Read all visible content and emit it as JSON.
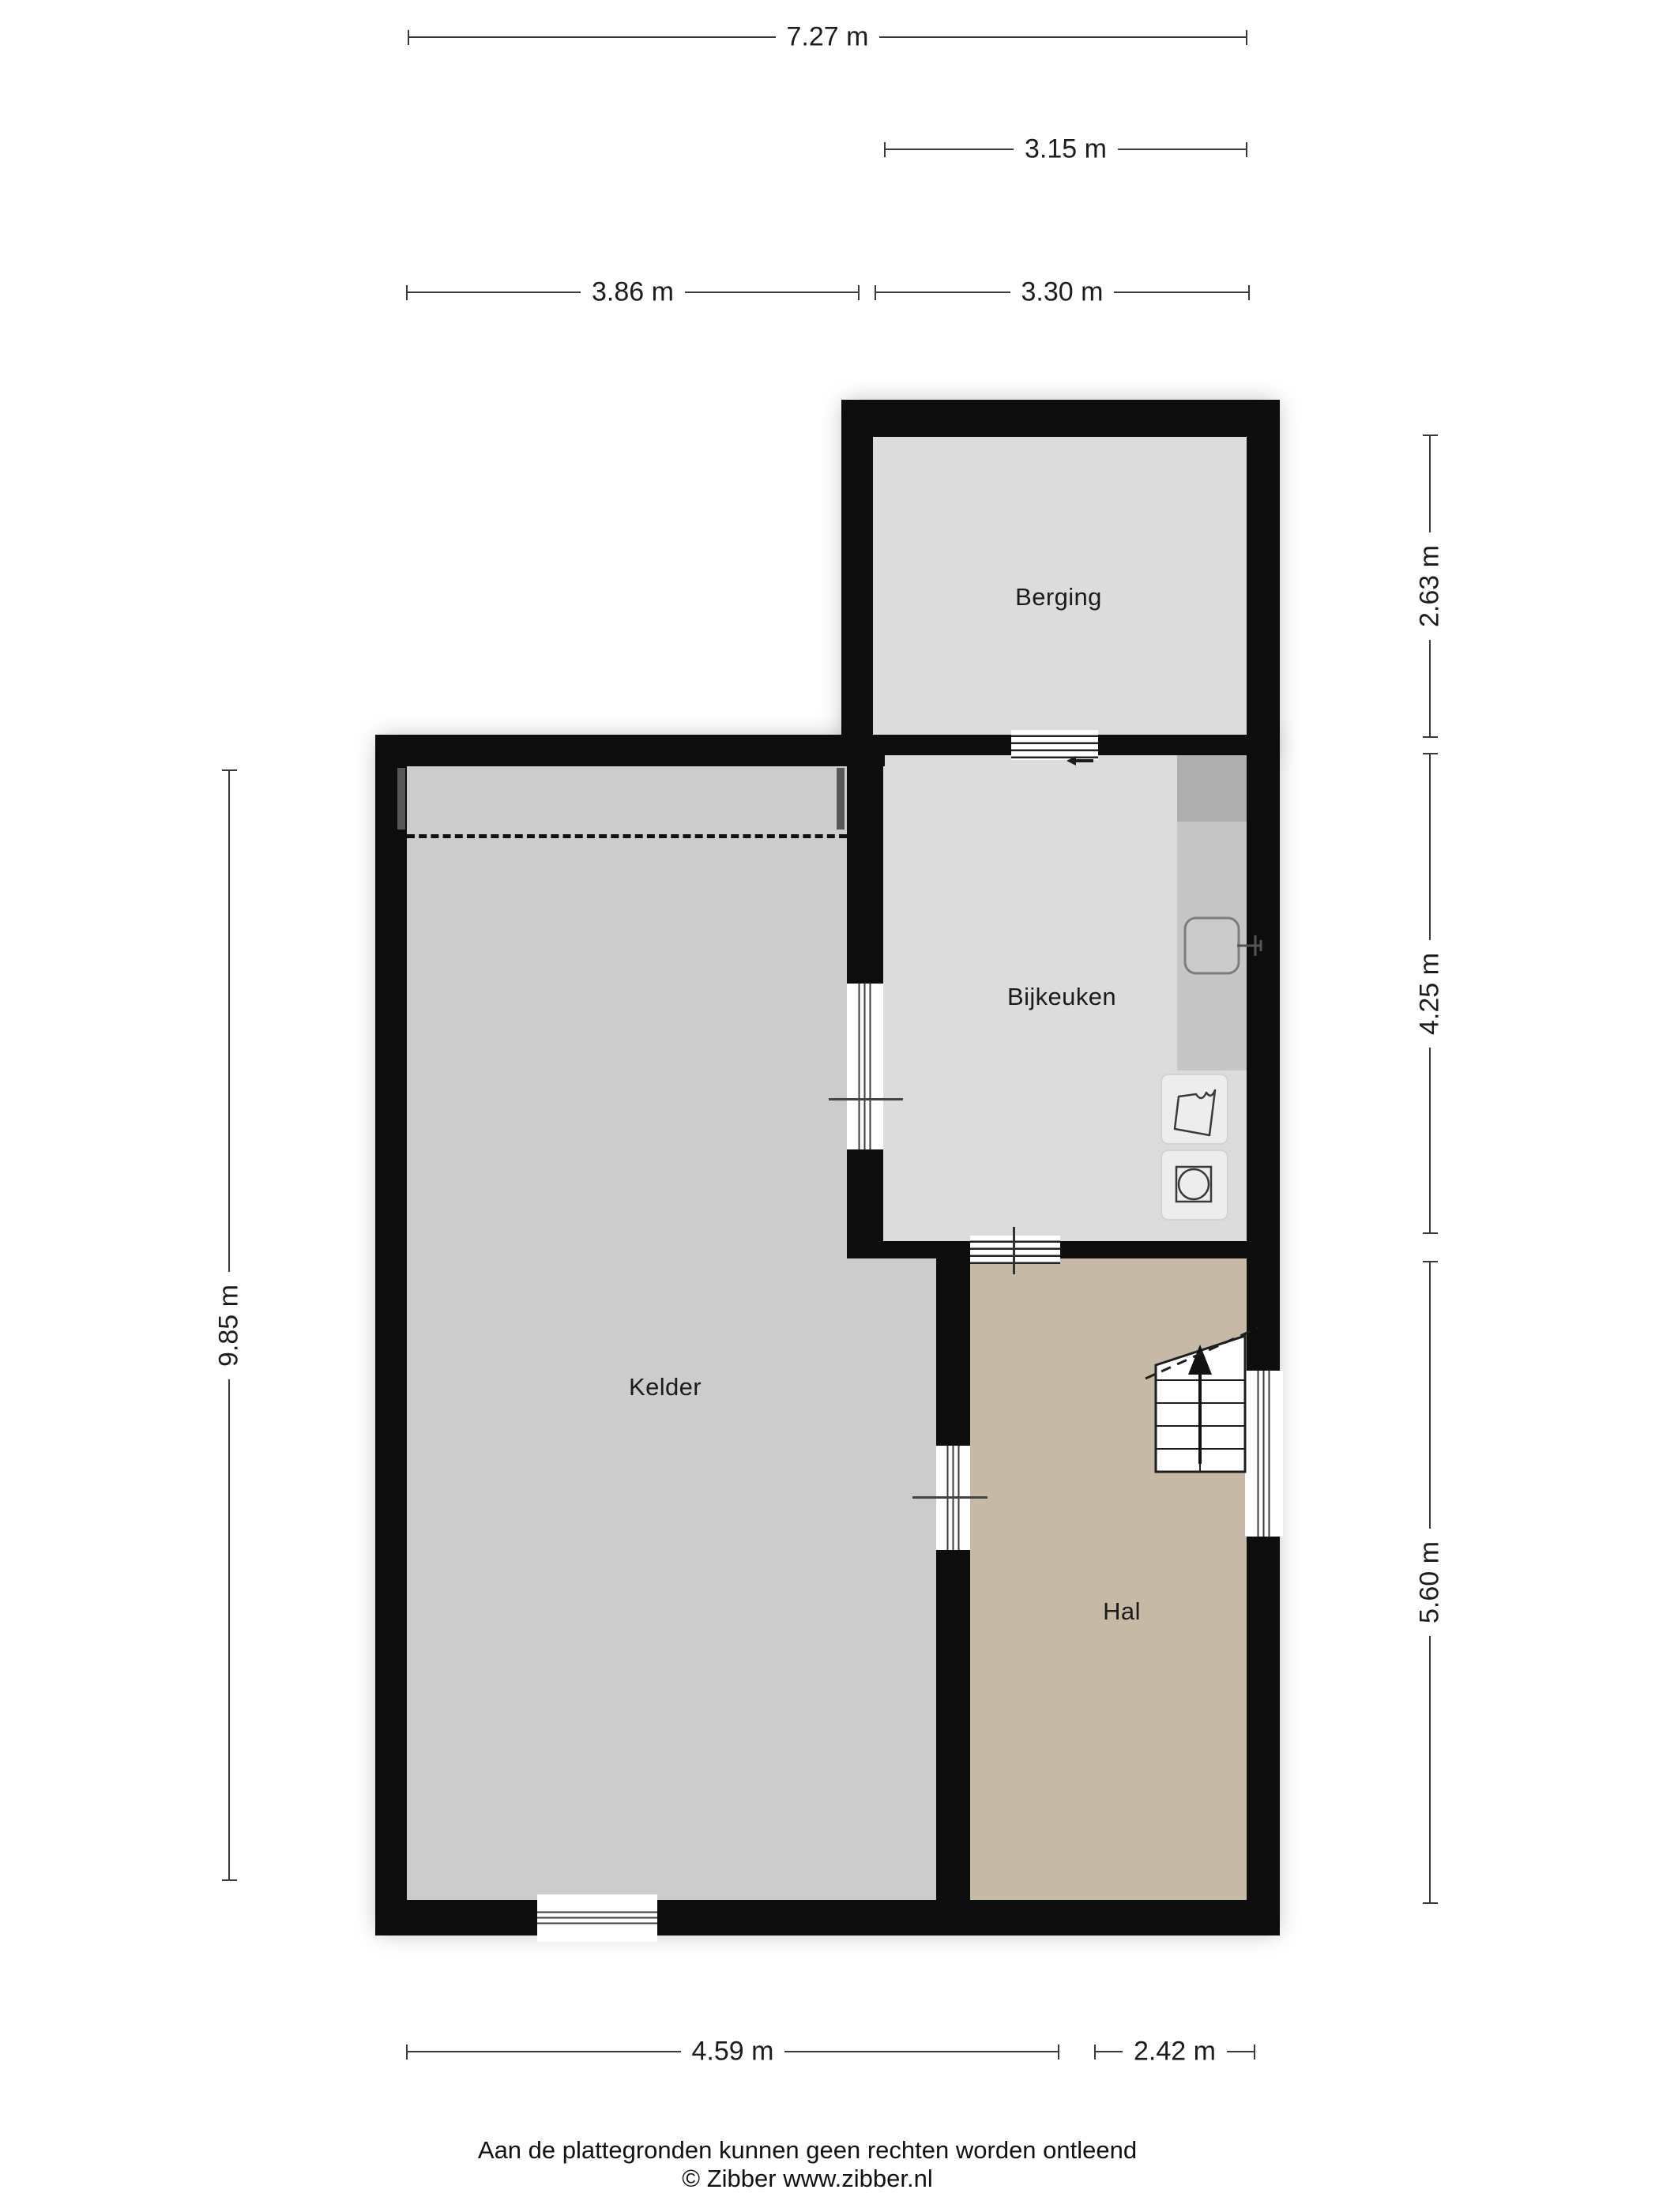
{
  "rooms": {
    "berging": {
      "label": "Berging"
    },
    "bijkeuken": {
      "label": "Bijkeuken"
    },
    "kelder": {
      "label": "Kelder"
    },
    "hal": {
      "label": "Hal"
    }
  },
  "dims": {
    "top_total": {
      "label": "7.27 m"
    },
    "top_berging": {
      "label": "3.15 m"
    },
    "mid_left": {
      "label": "3.86 m"
    },
    "mid_right": {
      "label": "3.30 m"
    },
    "left_total": {
      "label": "9.85 m"
    },
    "right_berging": {
      "label": "2.63 m"
    },
    "right_bijkeuken": {
      "label": "4.25 m"
    },
    "right_hal": {
      "label": "5.60 m"
    },
    "bottom_kelder": {
      "label": "4.59 m"
    },
    "bottom_hal": {
      "label": "2.42 m"
    }
  },
  "footer": {
    "disclaimer": "Aan de plattegronden kunnen geen rechten worden ontleend",
    "copyright": "© Zibber www.zibber.nl"
  },
  "icons": {
    "stairs": "stairs-up-arrow-icon",
    "sink": "kitchen-sink-icon",
    "basin": "laundry-basin-icon",
    "washer": "washing-machine-icon"
  },
  "colors": {
    "wall": "#0d0d0d",
    "room": "#dcdcdc",
    "kelder": "#cccccc",
    "hal": "#c6b9a5",
    "counter": "#c6c6c6",
    "counter_dark": "#aeaeae",
    "appliance": "#ededed",
    "dim_line": "#3a3a3a",
    "text": "#1c1c1c"
  }
}
